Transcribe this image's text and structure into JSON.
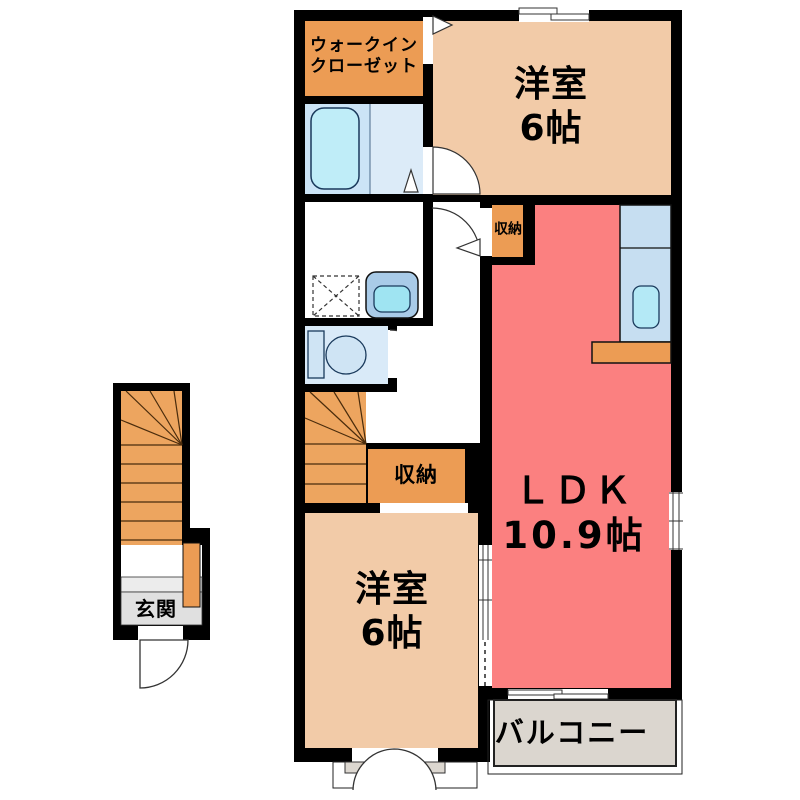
{
  "plan_type": "apartment-floor-plan",
  "labels": {
    "walk_in_closet": "ウォークイン\nクローゼット",
    "bedroom_top": "洋室\n6帖",
    "storage_upper": "収納",
    "storage_middle": "収納",
    "ldk": "ＬＤＫ\n10.9帖",
    "bedroom_bottom": "洋室\n6帖",
    "balcony": "バルコニー",
    "entrance": "玄関"
  },
  "colors": {
    "wall": "#000000",
    "bedroom_fill": "#F2CBA8",
    "ldk_fill": "#FB8080",
    "storage_fill": "#EC9C54",
    "stairs_fill": "#EDA55F",
    "bath_fill_left": "#CBE4F6",
    "bath_fill_right": "#DCEBF8",
    "toilet_room_fill": "#D9EAF8",
    "bathtub_fill": "#BFEDF8",
    "kitchen_fill": "#C6DEF1",
    "kitchen_sink_fill": "#B4E9F6",
    "vanity_fill": "#A9CBE8",
    "vanity_bowl_fill": "#9FE4F2",
    "toilet_fixture_fill": "#CFE4F4",
    "balcony_fill": "#DBD6CF",
    "entrance_step_fill": "#E0E0E0",
    "entrance_step_upper_fill": "#ECECEC"
  },
  "fixtures": [
    "bathtub-icon",
    "washing-machine-icon",
    "vanity-sink-icon",
    "toilet-icon",
    "kitchen-sink-icon",
    "kitchen-counter-icon",
    "indoor-stairs-icon",
    "entrance-stairs-icon",
    "door-swing-icon",
    "sliding-window-icon",
    "folding-door-icon",
    "bay-window-icon"
  ]
}
